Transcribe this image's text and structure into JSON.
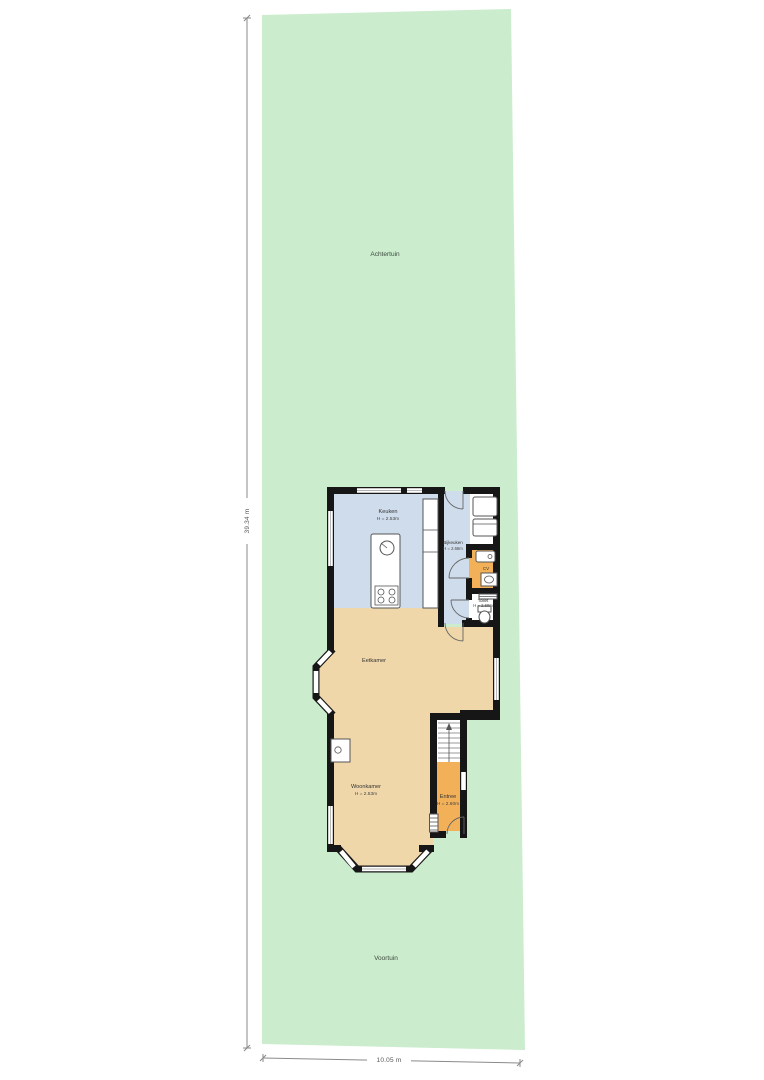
{
  "garden": {
    "back_label": "Achtertuin",
    "front_label": "Voortuin"
  },
  "dimensions": {
    "plot_depth": "39.34 m",
    "plot_width": "10.05 m"
  },
  "rooms": {
    "keuken": {
      "name": "Keuken",
      "ceiling": "H = 2.53m"
    },
    "bijkeuken": {
      "name": "Bijkeuken",
      "ceiling": "H = 2.66m"
    },
    "cv": {
      "name": "CV"
    },
    "toilet": {
      "name": "Toilet",
      "ceiling": "H = 2.60m"
    },
    "eetkamer": {
      "name": "Eetkamer"
    },
    "woonkamer": {
      "name": "Woonkamer",
      "ceiling": "H = 2.53m"
    },
    "entree": {
      "name": "Entree",
      "ceiling": "H = 2.60m"
    }
  },
  "colors": {
    "garden": "#cbeccd",
    "kitchen_floor": "#cfdceb",
    "living_floor": "#f0d7a9",
    "hall_floor": "#f2b159",
    "wall": "#161616",
    "fixture_stroke": "#555555"
  }
}
